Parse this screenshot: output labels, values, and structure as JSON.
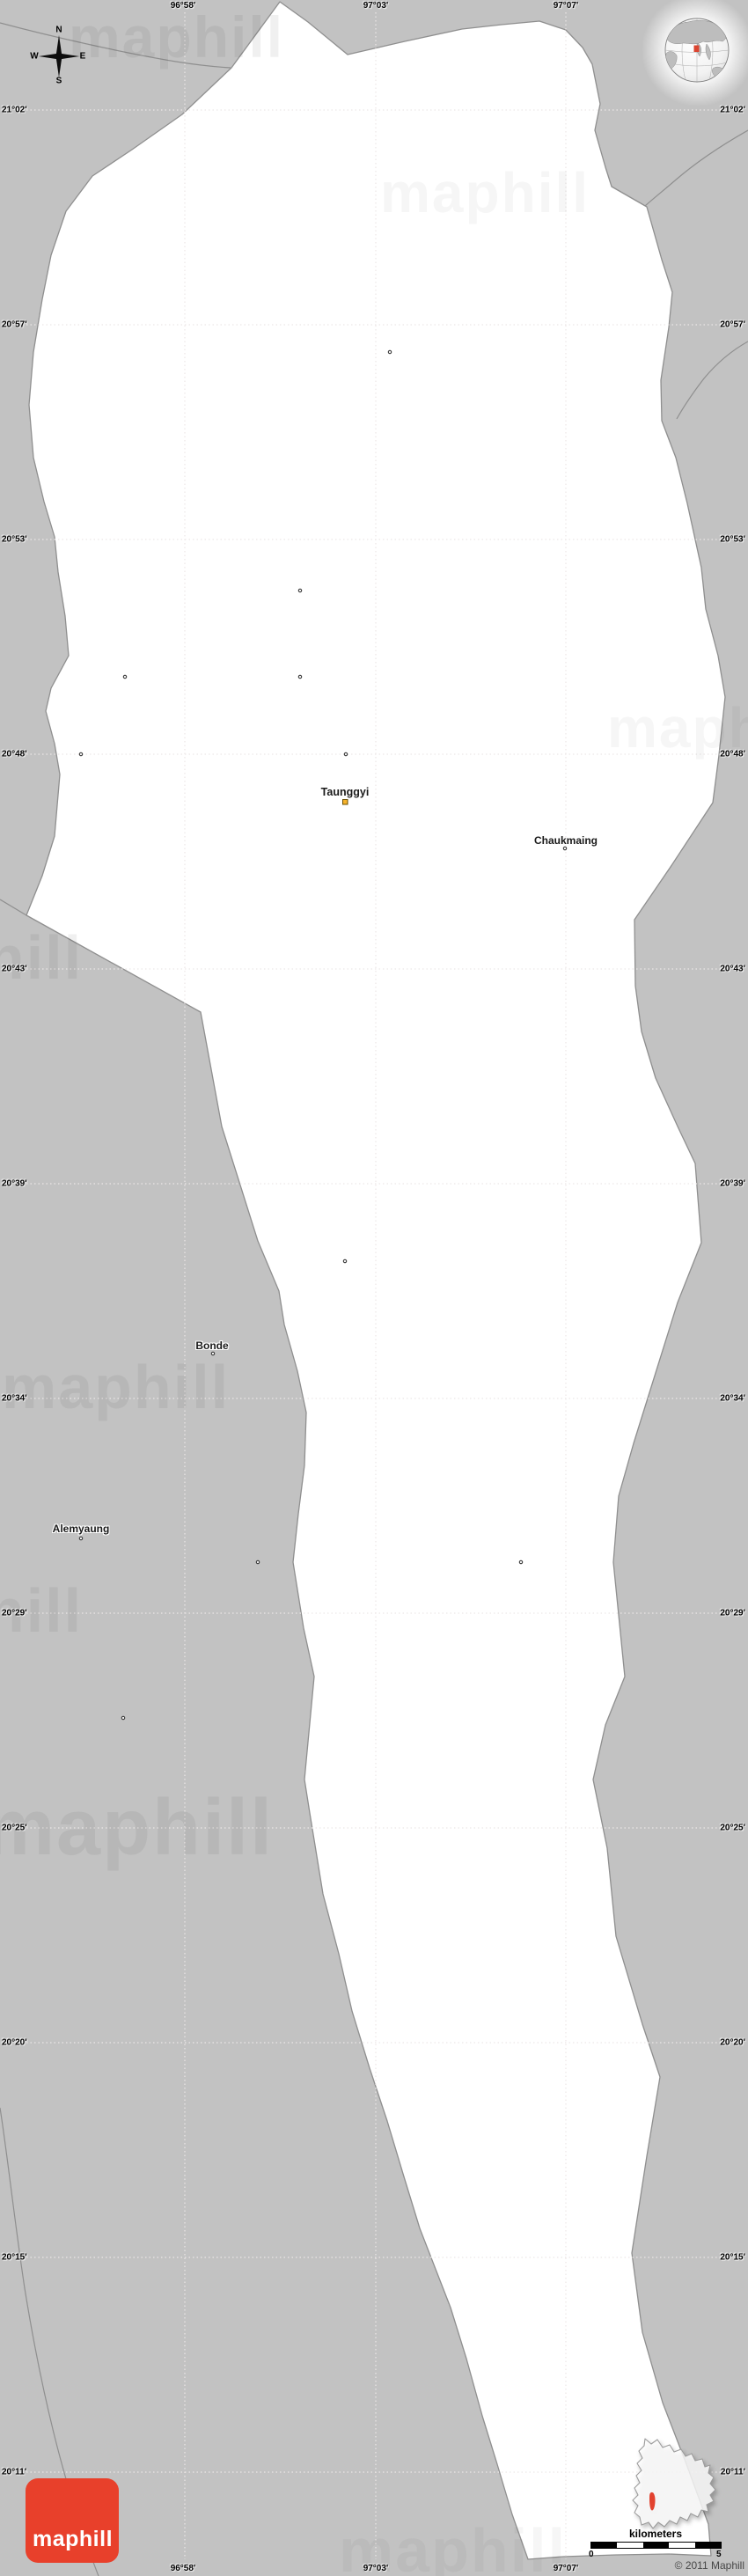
{
  "map": {
    "kind": "blank gray location map",
    "colors": {
      "background": "#c2c2c2",
      "land": "#ffffff",
      "boundary": "#8f8f8f",
      "gridline": "#ece8e8",
      "brand_red": "#e8402b",
      "town_marker_fill": "#f7b32b"
    }
  },
  "grid": {
    "lon_labels": [
      "96°58'",
      "97°03'",
      "97°07'"
    ],
    "lat_labels": [
      "21°02'",
      "20°57'",
      "20°53'",
      "20°48'",
      "20°43'",
      "20°39'",
      "20°34'",
      "20°29'",
      "20°25'",
      "20°20'",
      "20°15'",
      "20°11'"
    ]
  },
  "places": {
    "town": {
      "name": "Taunggyi"
    },
    "villages": [
      {
        "name": "Chaukmaing"
      },
      {
        "name": "Bonde"
      },
      {
        "name": "Alemyaung"
      }
    ]
  },
  "compass": {
    "north": "N",
    "east": "E",
    "south": "S",
    "west": "W"
  },
  "scale_bar": {
    "unit_label": "kilometers",
    "start_value": "0",
    "end_value": "5"
  },
  "copyright": "© 2011 Maphill",
  "logo": {
    "text": "maphill"
  },
  "watermark": {
    "text": "maphill"
  }
}
